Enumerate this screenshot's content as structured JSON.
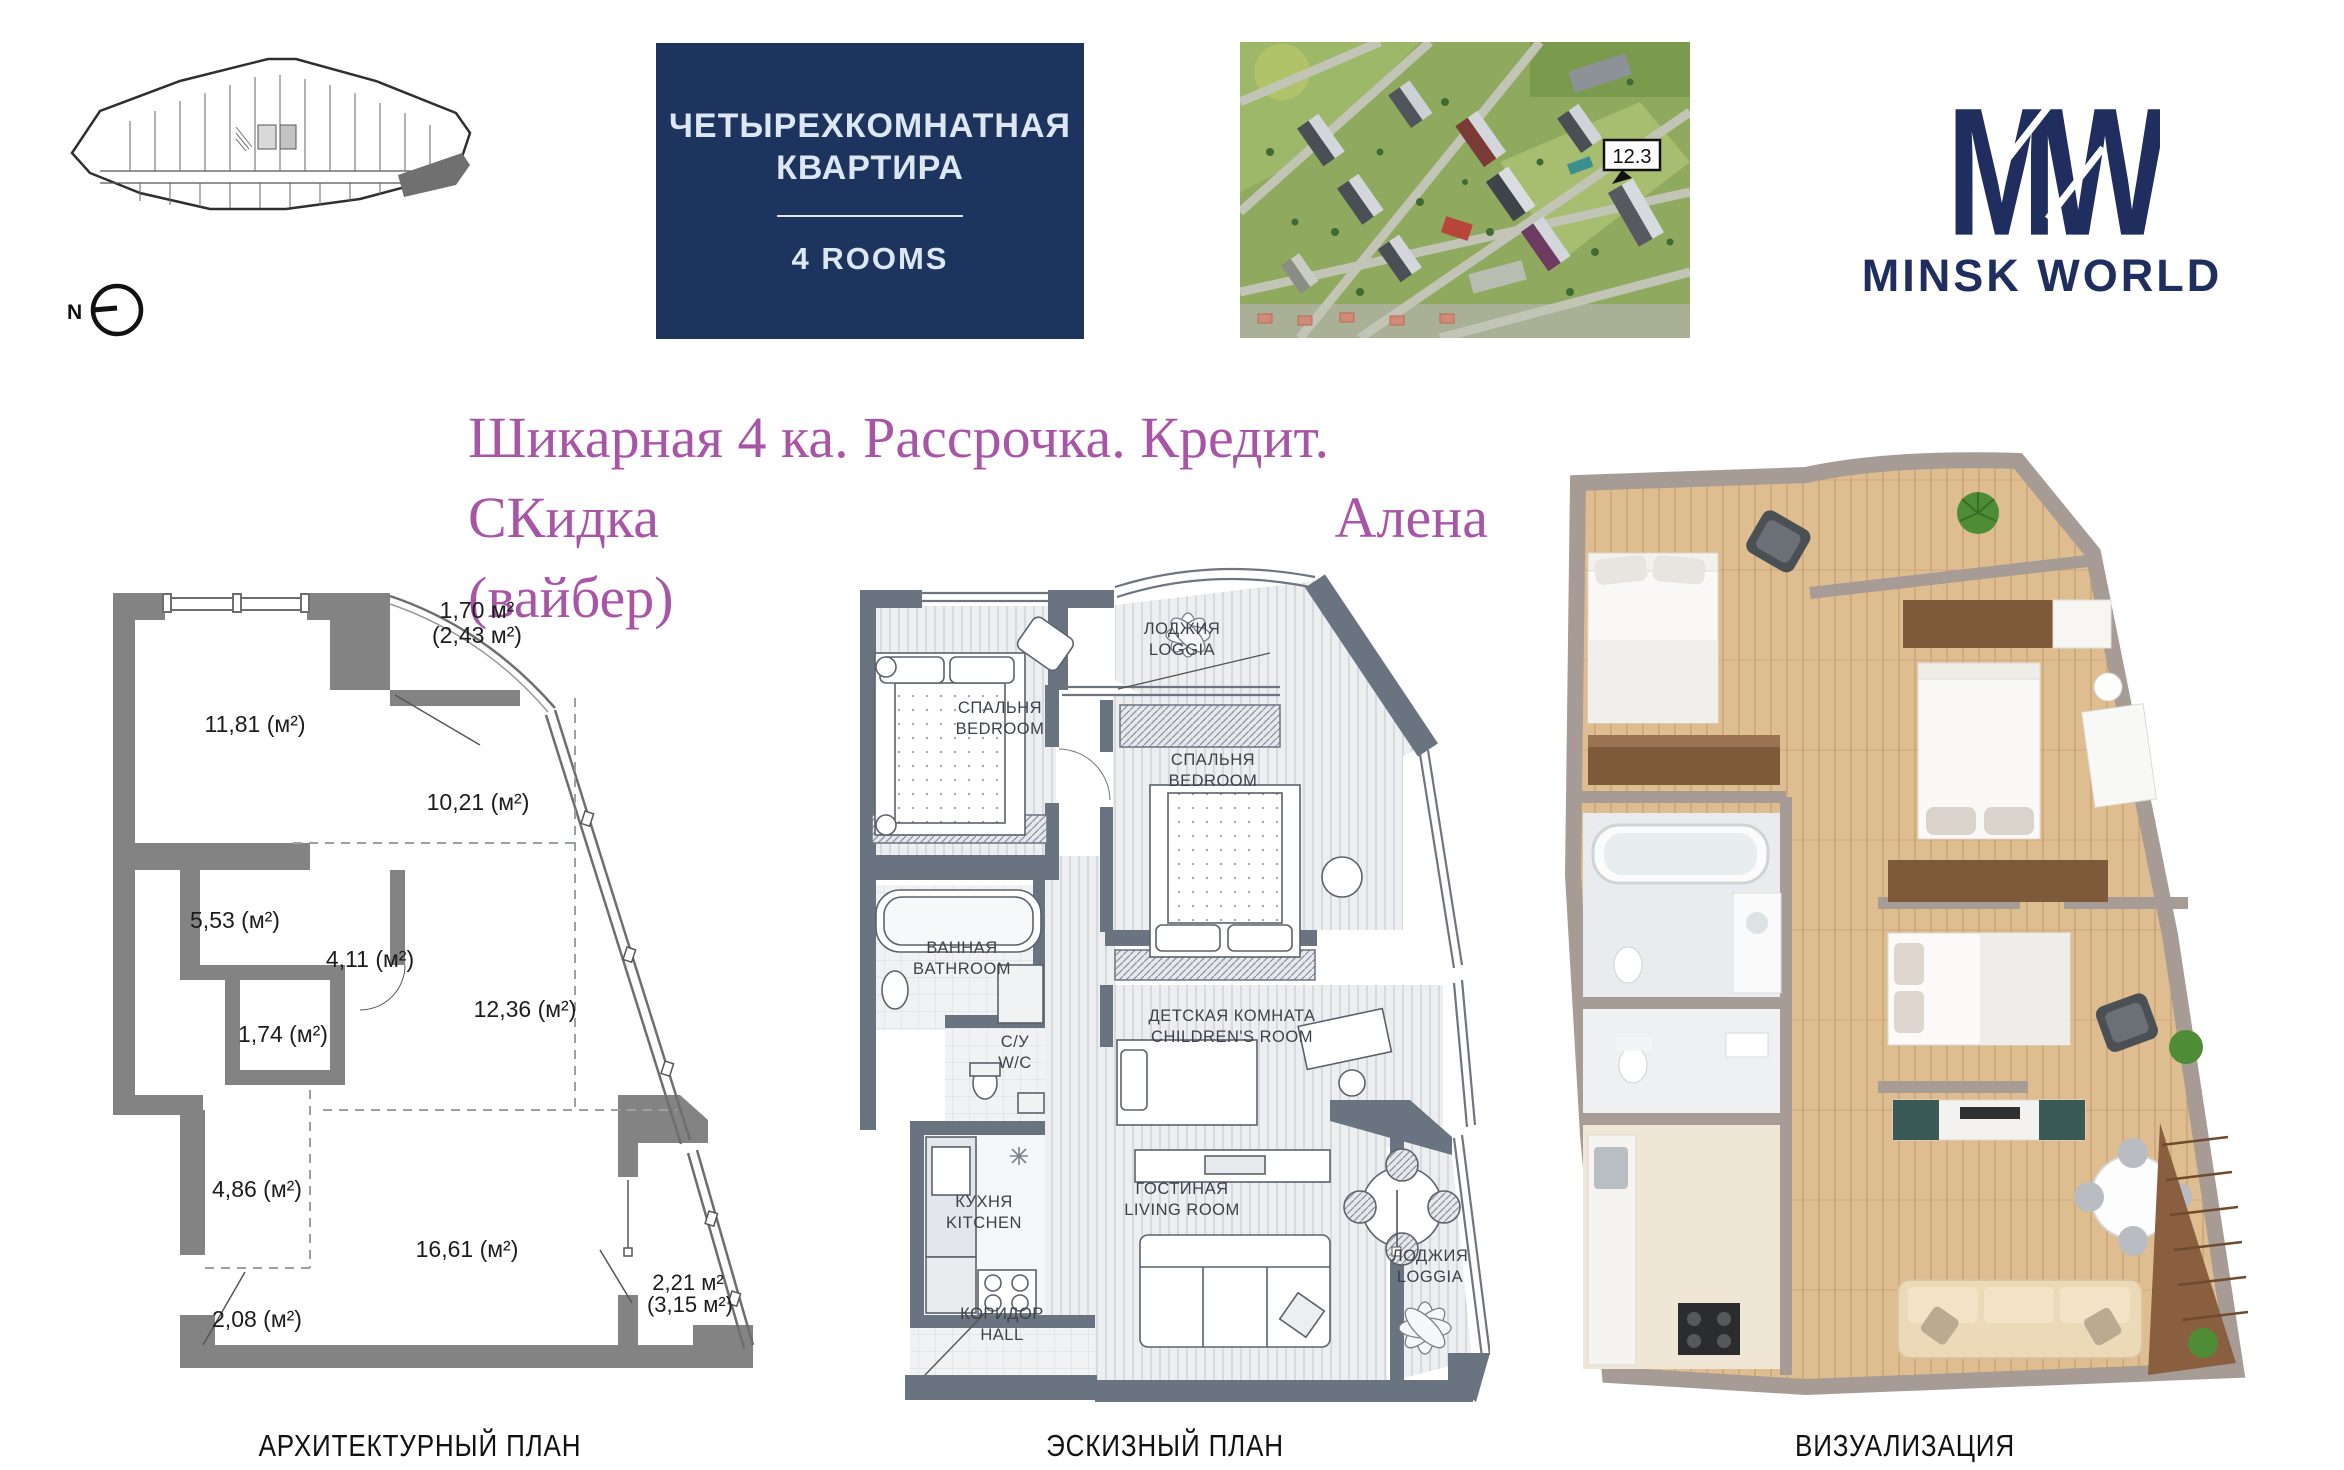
{
  "header": {
    "building_plan": {
      "north_label": "N"
    },
    "title_box": {
      "title_line1": "ЧЕТЫРЕХКОМНАТНАЯ",
      "title_line2": "КВАРТИРА",
      "subtitle": "4 ROOMS",
      "bg_color": "#1d345f"
    },
    "aerial": {
      "marker_label": "12.3"
    },
    "logo": {
      "monogram": "MW",
      "wordmark": "MINSK WORLD",
      "color": "#1f2e5f"
    }
  },
  "promo": {
    "line1": "Шикарная 4 ка. Рассрочка. Кредит.",
    "line2_left": "СКидка",
    "line2_right": "Алена",
    "line3": "(вайбер)",
    "color": "#a855a8"
  },
  "architectural_plan": {
    "caption": "АРХИТЕКТУРНЫЙ ПЛАН",
    "areas": {
      "bedroom": "11,81 (м²)",
      "loggia_top": "1,70 м²",
      "loggia_top_total": "(2,43 м²)",
      "room_right": "10,21 (м²)",
      "room_small": "5,53 (м²)",
      "hall_inner": "4,11 (м²)",
      "closet": "1,74 (м²)",
      "room_mid": "12,36 (м²)",
      "corridor": "4,86 (м²)",
      "living": "16,61 (м²)",
      "entry": "2,08 (м²)",
      "loggia_bottom": "2,21 м²",
      "loggia_bottom_total": "(3,15 м²)"
    }
  },
  "sketch_plan": {
    "caption": "ЭСКИЗНЫЙ ПЛАН",
    "rooms": {
      "bedroom1_ru": "СПАЛЬНЯ",
      "bedroom1_en": "BEDROOM",
      "loggia_top_ru": "ЛОДЖИЯ",
      "loggia_top_en": "LOGGIA",
      "bedroom2_ru": "СПАЛЬНЯ",
      "bedroom2_en": "BEDROOM",
      "bathroom_ru": "ВАННАЯ",
      "bathroom_en": "BATHROOM",
      "wc_ru": "С/У",
      "wc_en": "W/C",
      "children_ru": "ДЕТСКАЯ КОМНАТА",
      "children_en": "CHILDREN'S ROOM",
      "kitchen_ru": "КУХНЯ",
      "kitchen_en": "KITCHEN",
      "living_ru": "ГОСТИНАЯ",
      "living_en": "LIVING ROOM",
      "hall_ru": "КОРИДОР",
      "hall_en": "HALL",
      "loggia_bottom_ru": "ЛОДЖИЯ",
      "loggia_bottom_en": "LOGGIA"
    }
  },
  "visualization_plan": {
    "caption": "ВИЗУАЛИЗАЦИЯ"
  }
}
